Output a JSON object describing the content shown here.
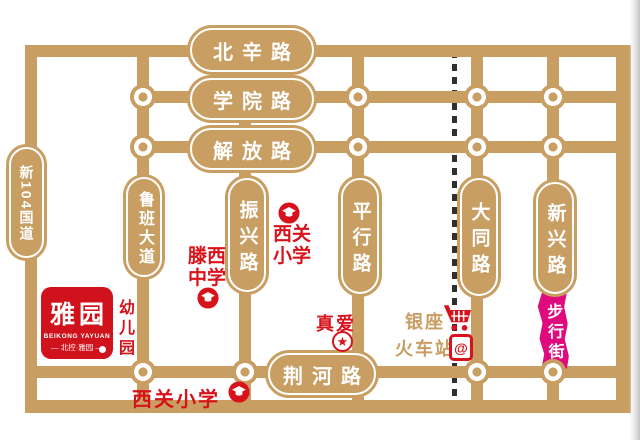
{
  "roads": {
    "beixin": "北辛路",
    "xueyuan": "学院路",
    "jiefang": "解放路",
    "jinghe": "荆河路",
    "g104": "新104国道",
    "luban": "鲁班大道",
    "zhenxing": "振兴路",
    "pingxing": "平行路",
    "datong": "大同路",
    "xinxing": "新兴路",
    "pedestrian": "步行街"
  },
  "pois": {
    "xiguan_primary_north": "西关小学",
    "tengxi_middle": "滕西中学",
    "xiguan_primary_south": "西关小学",
    "kindergarten": "幼儿园",
    "zhenai": "真爱",
    "zhenai_star": "★",
    "yinzuo": "银座",
    "railway_station": "火车站",
    "station_glyph": "@"
  },
  "logo": {
    "title": "雅园",
    "subtitle": "BEIKONG YAYUAN",
    "tagline": "— 北控·雅园 —"
  },
  "colors": {
    "road": "#C89E62",
    "red": "#D8121B",
    "logo_red": "#D0121C",
    "magenta": "#DF0A7C",
    "railway": "#2F2F2F"
  }
}
